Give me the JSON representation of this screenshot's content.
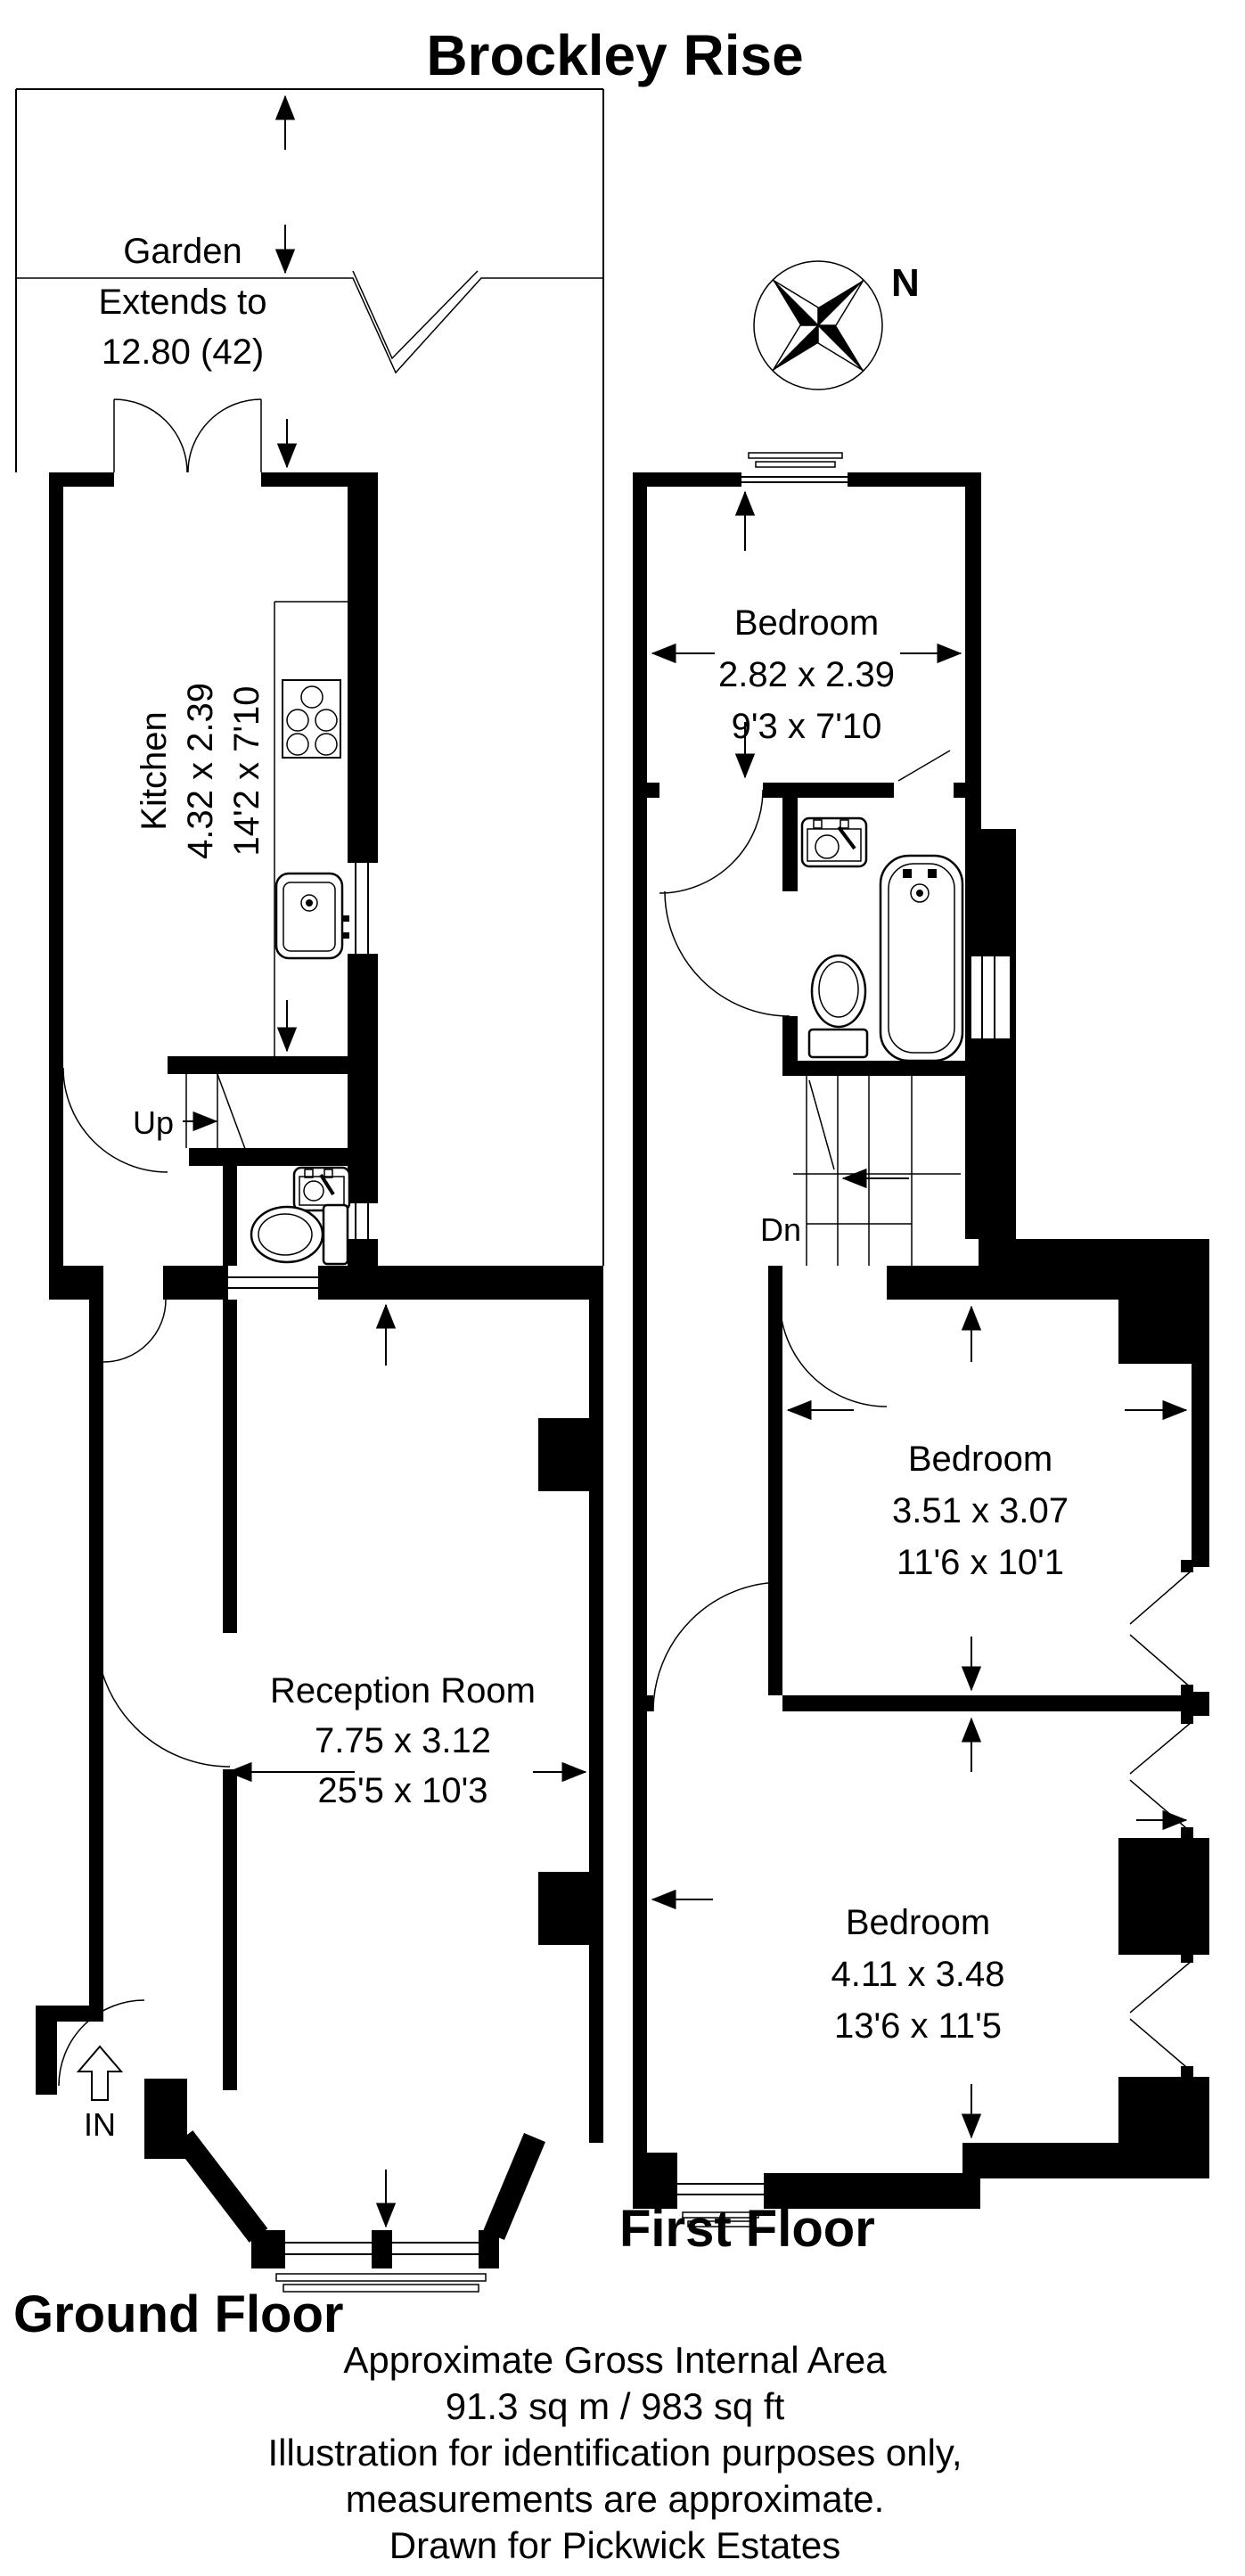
{
  "title": "Brockley Rise",
  "compass": {
    "north_label": "N"
  },
  "garden": {
    "line1": "Garden",
    "line2": "Extends to",
    "line3": "12.80 (42)"
  },
  "ground_floor": {
    "label": "Ground Floor",
    "kitchen": {
      "name": "Kitchen",
      "metric": "4.32 x 2.39",
      "imperial": "14'2 x 7'10"
    },
    "reception": {
      "name": "Reception Room",
      "metric": "7.75 x 3.12",
      "imperial": "25'5 x 10'3"
    },
    "stairs_label": "Up",
    "entrance_label": "IN"
  },
  "first_floor": {
    "label": "First Floor",
    "bedroom_rear": {
      "name": "Bedroom",
      "metric": "2.82 x 2.39",
      "imperial": "9'3 x 7'10"
    },
    "bedroom_middle": {
      "name": "Bedroom",
      "metric": "3.51 x 3.07",
      "imperial": "11'6 x 10'1"
    },
    "bedroom_front": {
      "name": "Bedroom",
      "metric": "4.11 x 3.48",
      "imperial": "13'6 x 11'5"
    },
    "stairs_label": "Dn"
  },
  "footer": {
    "lines": [
      "Approximate Gross Internal Area",
      "91.3 sq m / 983 sq ft",
      "Illustration for identification purposes only,",
      "measurements are approximate.",
      "Drawn for Pickwick Estates"
    ]
  }
}
